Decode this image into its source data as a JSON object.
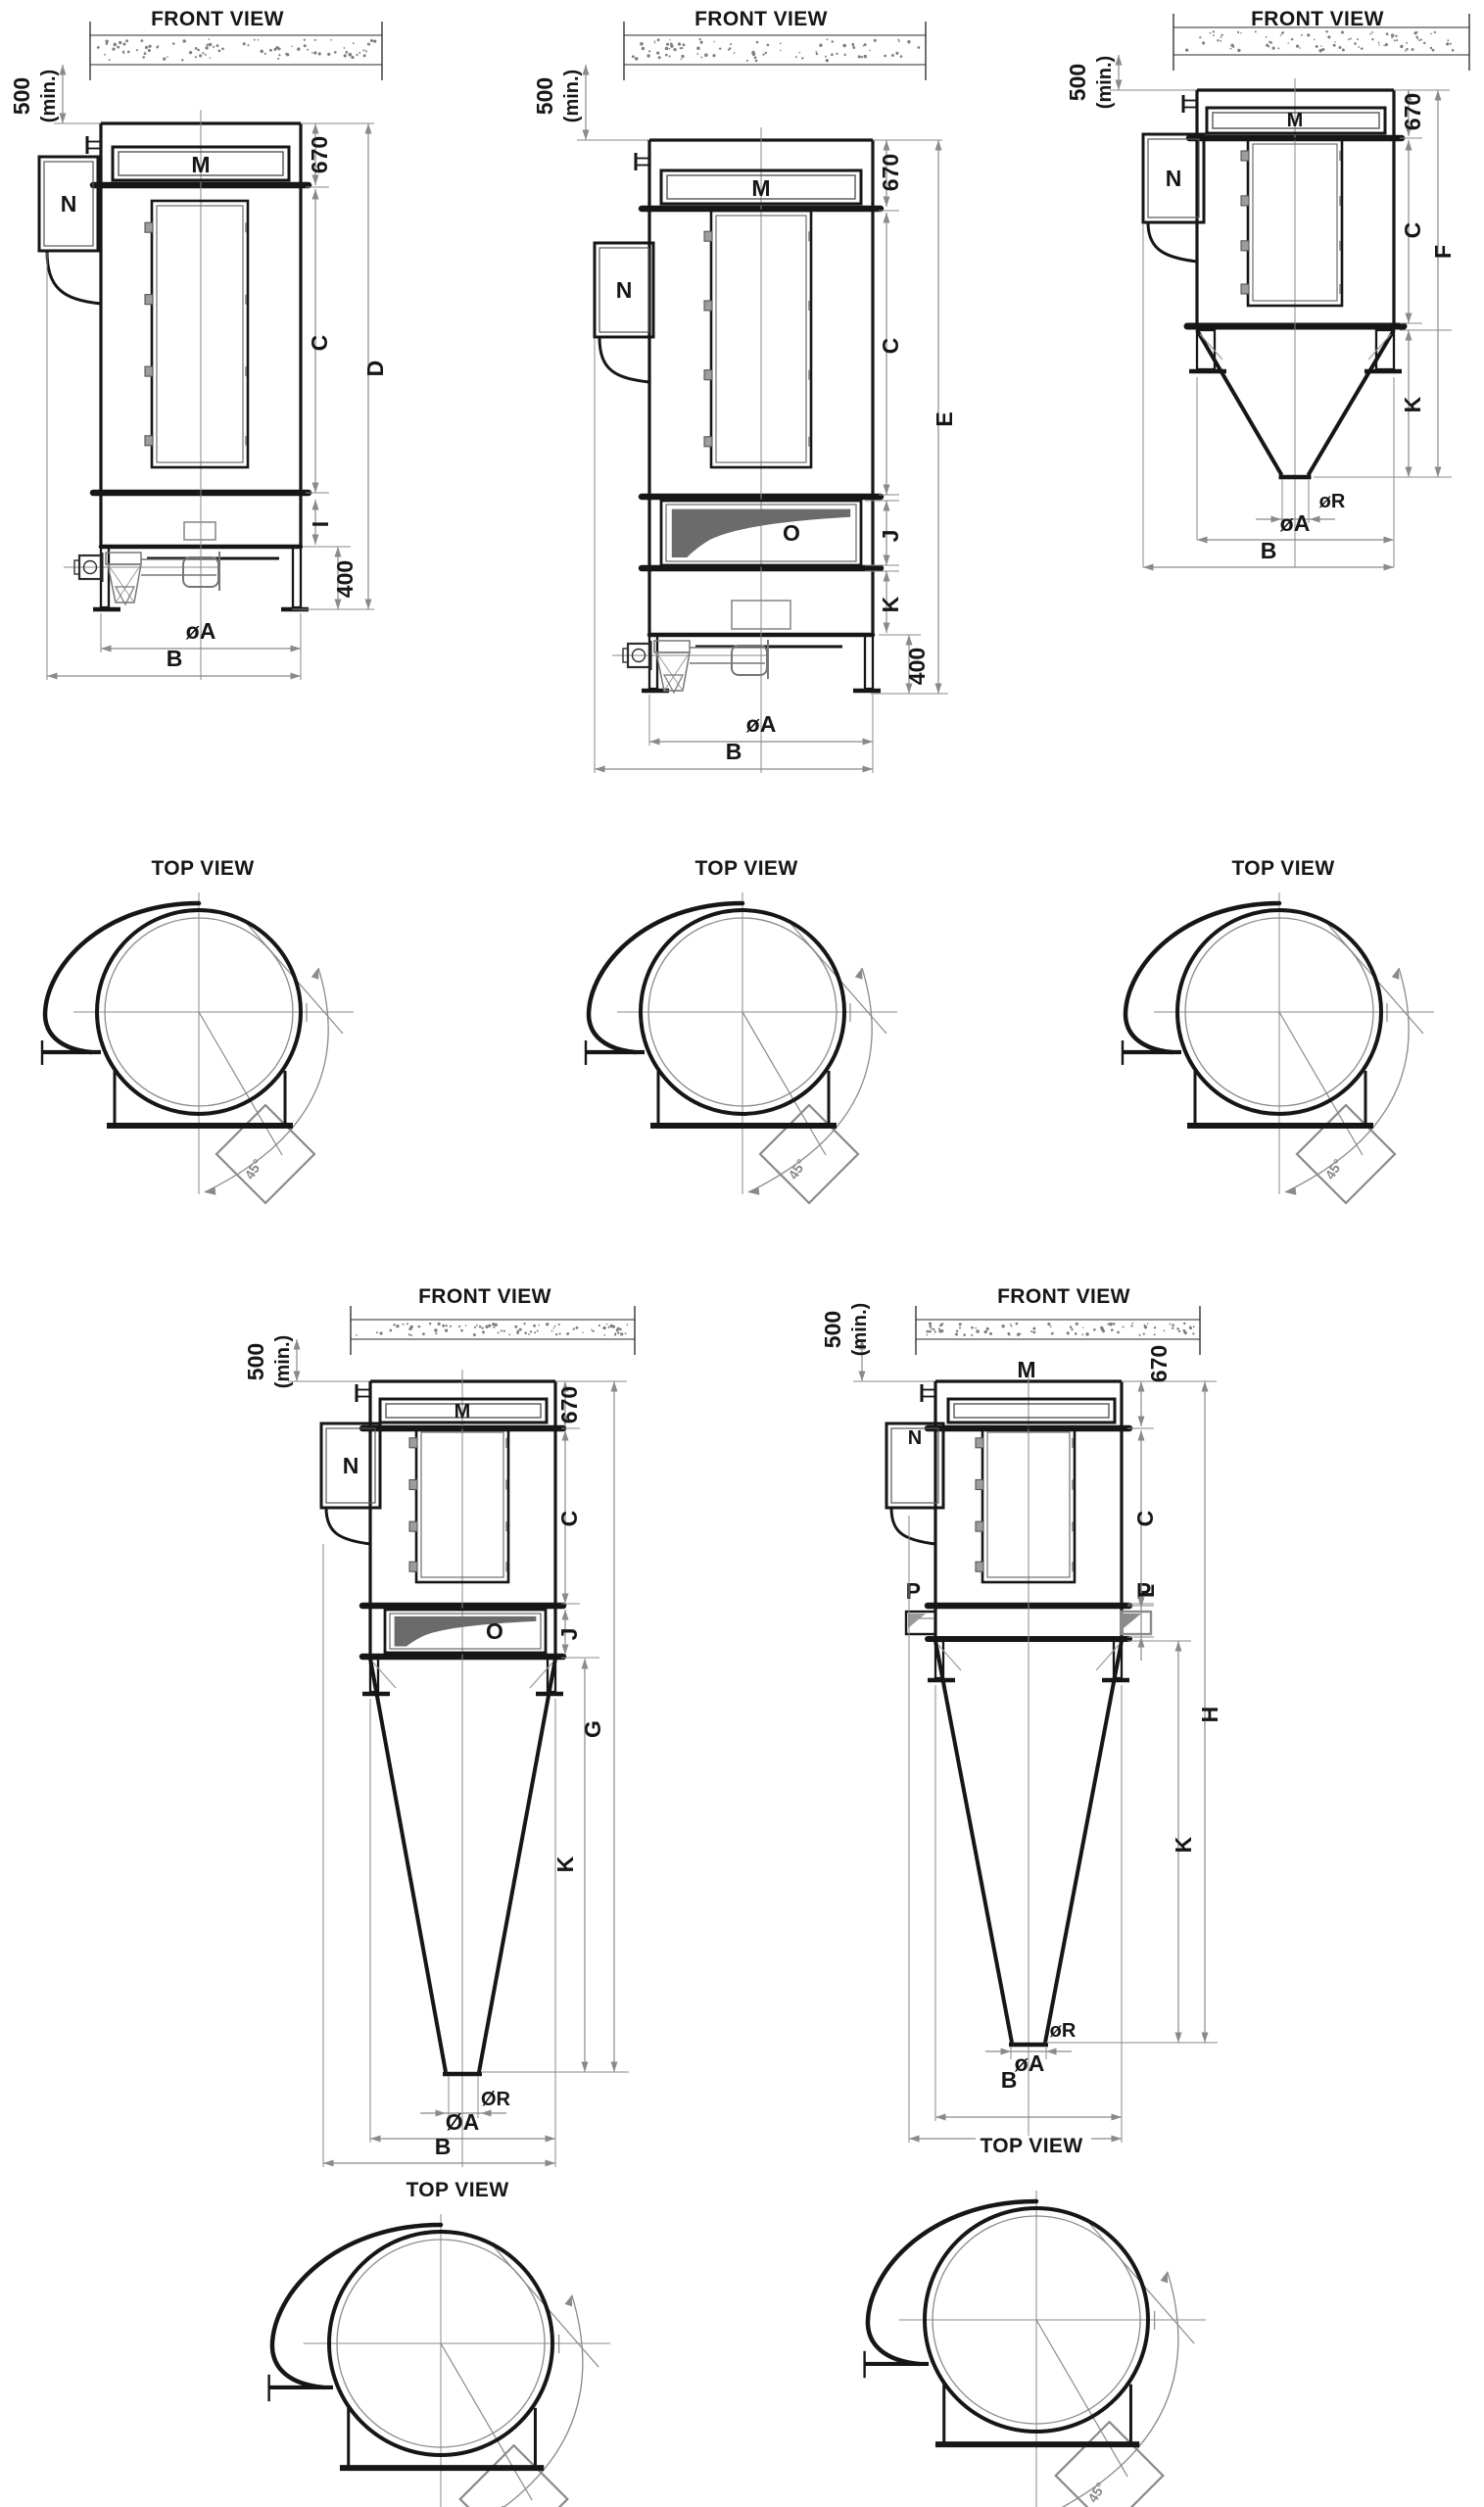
{
  "drawing": {
    "front_view_title": "FRONT VIEW",
    "top_view_title": "TOP VIEW",
    "ceiling_clearance": {
      "value": "500",
      "qualifier": "(min.)"
    },
    "clean_air_section_height": "670",
    "stand_height": "400",
    "outlet_rotation_angle": "45°",
    "colors": {
      "line": "#161616",
      "dimension": "#8a8a8a",
      "dark_fill": "#6b6b6b"
    }
  },
  "units": [
    {
      "id": "unit-1",
      "labels": {
        "top_port": "M",
        "side_box": "N"
      },
      "dims": {
        "body_height": "C",
        "total_height": "D",
        "base_section": "I",
        "base_diameter": "øA",
        "overall_width": "B"
      }
    },
    {
      "id": "unit-2",
      "labels": {
        "top_port": "M",
        "side_box": "N",
        "screw_conveyor": "O"
      },
      "dims": {
        "body_height": "C",
        "total_height": "E",
        "screw_section": "J",
        "base_section": "K",
        "base_diameter": "øA",
        "overall_width": "B"
      }
    },
    {
      "id": "unit-3",
      "labels": {
        "top_port": "M",
        "side_box": "N"
      },
      "dims": {
        "body_height": "C",
        "total_height": "F",
        "hopper_section": "K",
        "outlet_diameter": "øR",
        "base_diameter": "øA",
        "overall_width": "B"
      }
    },
    {
      "id": "unit-4",
      "labels": {
        "top_port": "M",
        "side_box": "N",
        "screw_conveyor": "O"
      },
      "dims": {
        "body_height": "C",
        "total_height": "G",
        "screw_section": "J",
        "hopper_section": "K",
        "outlet_diameter": "ØR",
        "base_diameter": "ØA",
        "overall_width": "B"
      }
    },
    {
      "id": "unit-5",
      "labels": {
        "top_port": "M",
        "side_box": "N",
        "side_port_left": "P",
        "side_port_right": "P"
      },
      "dims": {
        "body_height": "C",
        "total_height": "H",
        "side_port_section": "L",
        "hopper_section": "K",
        "outlet_diameter": "øR",
        "base_diameter": "øA",
        "overall_width": "B"
      }
    }
  ]
}
